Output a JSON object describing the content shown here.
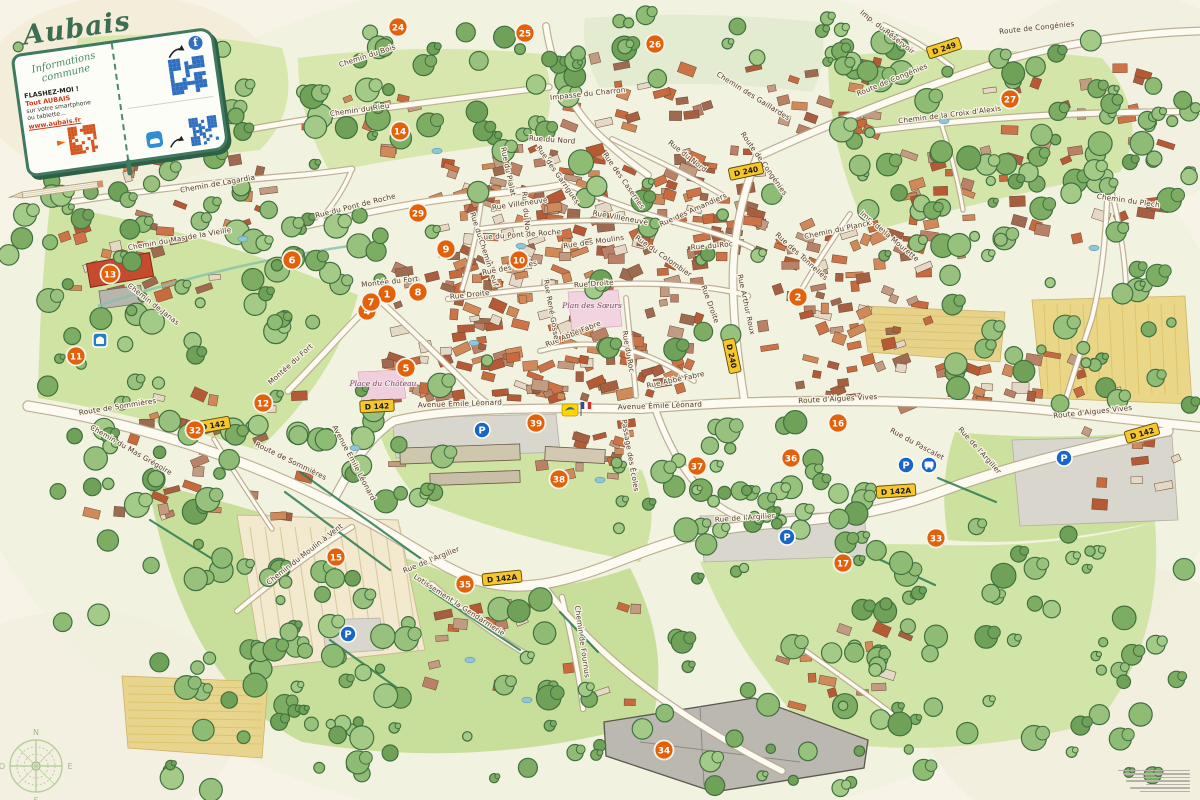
{
  "title": "Aubais",
  "legend": {
    "subtitle_line1": "Informations",
    "subtitle_line2": "commune",
    "flash_title": "FLASHEZ-MOI !",
    "flash_line1": "Tout AUBAIS",
    "flash_line2": "sur votre smartphone",
    "flash_line3": "ou tablette...",
    "flash_url": "www.aubais.fr"
  },
  "compass": {
    "north": "N",
    "south": "S",
    "east": "E",
    "west": "O"
  },
  "colors": {
    "paper": "#f7f3e7",
    "marker_orange": "#e2610b",
    "sign_yellow": "#f6c62f",
    "parking_blue": "#1766c8",
    "accent_red": "#d2391e",
    "cover_green": "#3f7a5e",
    "field_green": "#cfe3a2",
    "roof_terracotta": "#c76b3e"
  },
  "markers": [
    {
      "n": "1",
      "x": 387,
      "y": 294
    },
    {
      "n": "2",
      "x": 798,
      "y": 297
    },
    {
      "n": "4",
      "x": 367,
      "y": 311
    },
    {
      "n": "5",
      "x": 406,
      "y": 368
    },
    {
      "n": "6",
      "x": 292,
      "y": 260
    },
    {
      "n": "7",
      "x": 371,
      "y": 302
    },
    {
      "n": "8",
      "x": 418,
      "y": 292
    },
    {
      "n": "9",
      "x": 446,
      "y": 249
    },
    {
      "n": "10",
      "x": 519,
      "y": 260
    },
    {
      "n": "11",
      "x": 76,
      "y": 356
    },
    {
      "n": "12",
      "x": 263,
      "y": 403
    },
    {
      "n": "13",
      "x": 110,
      "y": 274
    },
    {
      "n": "14",
      "x": 400,
      "y": 131
    },
    {
      "n": "15",
      "x": 336,
      "y": 557
    },
    {
      "n": "16",
      "x": 838,
      "y": 423
    },
    {
      "n": "17",
      "x": 843,
      "y": 563
    },
    {
      "n": "24",
      "x": 398,
      "y": 27
    },
    {
      "n": "25",
      "x": 525,
      "y": 33
    },
    {
      "n": "26",
      "x": 655,
      "y": 44
    },
    {
      "n": "27",
      "x": 1010,
      "y": 99
    },
    {
      "n": "29",
      "x": 418,
      "y": 213
    },
    {
      "n": "32",
      "x": 195,
      "y": 430
    },
    {
      "n": "33",
      "x": 936,
      "y": 538
    },
    {
      "n": "34",
      "x": 664,
      "y": 750
    },
    {
      "n": "35",
      "x": 465,
      "y": 584
    },
    {
      "n": "36",
      "x": 791,
      "y": 458
    },
    {
      "n": "37",
      "x": 697,
      "y": 466
    },
    {
      "n": "38",
      "x": 559,
      "y": 479
    },
    {
      "n": "39",
      "x": 536,
      "y": 423
    }
  ],
  "street_labels": [
    {
      "name": "Chemin du Rieu",
      "x": 360,
      "y": 112,
      "r": -8
    },
    {
      "name": "Chemin du Bois",
      "x": 368,
      "y": 58,
      "r": -18
    },
    {
      "name": "Chemin des Gaillardes",
      "x": 752,
      "y": 98,
      "r": 32
    },
    {
      "name": "Impasse du Charron",
      "x": 588,
      "y": 96,
      "r": -6
    },
    {
      "name": "Rue du Nord",
      "x": 552,
      "y": 142,
      "r": 4
    },
    {
      "name": "Rue du Nord",
      "x": 524,
      "y": 215,
      "r": 85
    },
    {
      "name": "Rue du Nord",
      "x": 686,
      "y": 158,
      "r": 38
    },
    {
      "name": "Route de Congénies",
      "x": 1037,
      "y": 30,
      "r": -6
    },
    {
      "name": "Route de Congénies",
      "x": 893,
      "y": 82,
      "r": -22
    },
    {
      "name": "Route de Congénies",
      "x": 762,
      "y": 165,
      "r": 55
    },
    {
      "name": "Imp. du Réservoir",
      "x": 886,
      "y": 34,
      "r": 38
    },
    {
      "name": "Chemin de la Croix d'Alexis",
      "x": 950,
      "y": 117,
      "r": -7
    },
    {
      "name": "Chemin du Plech",
      "x": 1128,
      "y": 203,
      "r": 8
    },
    {
      "name": "Chemin de Lagardia",
      "x": 218,
      "y": 186,
      "r": -10
    },
    {
      "name": "Chemin du Mas de la Vieille",
      "x": 180,
      "y": 241,
      "r": -10
    },
    {
      "name": "Chemin de Janas",
      "x": 152,
      "y": 306,
      "r": 38
    },
    {
      "name": "Rue du Pont de Roche",
      "x": 356,
      "y": 208,
      "r": -14
    },
    {
      "name": "Rue du Pont de Roche",
      "x": 520,
      "y": 237,
      "r": -4
    },
    {
      "name": "Rue du Chemin Neuf",
      "x": 482,
      "y": 250,
      "r": 72
    },
    {
      "name": "Rue Villeneuve",
      "x": 520,
      "y": 206,
      "r": -8
    },
    {
      "name": "Rue Villeneuve",
      "x": 620,
      "y": 220,
      "r": 10
    },
    {
      "name": "Rue des Garrigues",
      "x": 556,
      "y": 176,
      "r": 55
    },
    {
      "name": "Rue des Casernes",
      "x": 622,
      "y": 182,
      "r": 55
    },
    {
      "name": "Rue du Pialat",
      "x": 506,
      "y": 172,
      "r": 78
    },
    {
      "name": "Rue des Halles",
      "x": 510,
      "y": 270,
      "r": -10
    },
    {
      "name": "Rue Droite",
      "x": 470,
      "y": 297,
      "r": -6
    },
    {
      "name": "Rue Droite",
      "x": 594,
      "y": 286,
      "r": -4
    },
    {
      "name": "Rue Droite",
      "x": 708,
      "y": 305,
      "r": 70
    },
    {
      "name": "Montée du Fort",
      "x": 390,
      "y": 284,
      "r": -6
    },
    {
      "name": "Montée du Fort",
      "x": 292,
      "y": 366,
      "r": -42
    },
    {
      "name": "Rue des Amandiers",
      "x": 694,
      "y": 212,
      "r": -24
    },
    {
      "name": "Rue des Moulins",
      "x": 594,
      "y": 244,
      "r": -8
    },
    {
      "name": "Rue du Colombier",
      "x": 662,
      "y": 258,
      "r": 35
    },
    {
      "name": "Rue des Tonnelles",
      "x": 800,
      "y": 258,
      "r": 42
    },
    {
      "name": "Imp. de la Mourette",
      "x": 888,
      "y": 238,
      "r": 40
    },
    {
      "name": "Chemin du Planck",
      "x": 838,
      "y": 232,
      "r": -12
    },
    {
      "name": "Rue Arthur Roux",
      "x": 744,
      "y": 305,
      "r": 78
    },
    {
      "name": "Rue du Roc",
      "x": 626,
      "y": 352,
      "r": 80
    },
    {
      "name": "Rue du Roc",
      "x": 712,
      "y": 248,
      "r": -5
    },
    {
      "name": "Rue Abbé Fabre",
      "x": 574,
      "y": 336,
      "r": -22
    },
    {
      "name": "Rue Abbé Fabre",
      "x": 676,
      "y": 382,
      "r": -12
    },
    {
      "name": "Rue René Gosse",
      "x": 549,
      "y": 310,
      "r": 80
    },
    {
      "name": "Avenue Émile Léonard",
      "x": 460,
      "y": 406,
      "r": -2
    },
    {
      "name": "Avenue Émile Léonard",
      "x": 660,
      "y": 408,
      "r": -2
    },
    {
      "name": "Avenue Émile Léonard",
      "x": 352,
      "y": 464,
      "r": 62
    },
    {
      "name": "Route d'Aigues Vives",
      "x": 838,
      "y": 401,
      "r": -3
    },
    {
      "name": "Route d'Aigues Vives",
      "x": 1093,
      "y": 414,
      "r": -6
    },
    {
      "name": "Rue de l'Argilier",
      "x": 745,
      "y": 520,
      "r": -4
    },
    {
      "name": "Rue de l'Argilier",
      "x": 978,
      "y": 452,
      "r": 48
    },
    {
      "name": "Rue de l'Argilier",
      "x": 432,
      "y": 562,
      "r": -22
    },
    {
      "name": "Rue du Pascalet",
      "x": 916,
      "y": 446,
      "r": 28
    },
    {
      "name": "Passage des Écoles",
      "x": 628,
      "y": 456,
      "r": 80
    },
    {
      "name": "Route de Sommières",
      "x": 118,
      "y": 409,
      "r": -9
    },
    {
      "name": "Route de Sommières",
      "x": 290,
      "y": 463,
      "r": 26
    },
    {
      "name": "Chemin du Mas Grégoire",
      "x": 130,
      "y": 452,
      "r": 30
    },
    {
      "name": "Chemin du Moulin à Vent",
      "x": 306,
      "y": 556,
      "r": -38
    },
    {
      "name": "Lotissement la Gendarmerie",
      "x": 458,
      "y": 607,
      "r": 33
    },
    {
      "name": "Chemin de Fournus",
      "x": 580,
      "y": 642,
      "r": 82
    }
  ],
  "place_labels": [
    {
      "name": "Place du Château",
      "x": 383,
      "y": 386
    },
    {
      "name": "Plan des Sœurs",
      "x": 592,
      "y": 308
    }
  ],
  "road_signs": [
    {
      "label": "D 249",
      "x": 944,
      "y": 48,
      "r": -18
    },
    {
      "label": "D 240",
      "x": 746,
      "y": 171,
      "r": -12
    },
    {
      "label": "D 240",
      "x": 732,
      "y": 356,
      "r": 78
    },
    {
      "label": "D 142",
      "x": 213,
      "y": 425,
      "r": -10
    },
    {
      "label": "D 142",
      "x": 377,
      "y": 406,
      "r": -3
    },
    {
      "label": "D 142",
      "x": 1142,
      "y": 433,
      "r": -16
    },
    {
      "label": "D 142A",
      "x": 502,
      "y": 578,
      "r": -6
    },
    {
      "label": "D 142A",
      "x": 896,
      "y": 491,
      "r": -4
    }
  ],
  "parking_icons": [
    {
      "x": 482,
      "y": 430
    },
    {
      "x": 787,
      "y": 537
    },
    {
      "x": 906,
      "y": 465
    },
    {
      "x": 1064,
      "y": 458
    },
    {
      "x": 348,
      "y": 634
    }
  ],
  "poi_icons": [
    {
      "type": "bus-icon",
      "x": 929,
      "y": 465
    },
    {
      "type": "monument-icon",
      "x": 100,
      "y": 340
    },
    {
      "type": "post-office-icon",
      "x": 570,
      "y": 410
    },
    {
      "type": "french-flag-icon",
      "x": 586,
      "y": 409
    }
  ]
}
